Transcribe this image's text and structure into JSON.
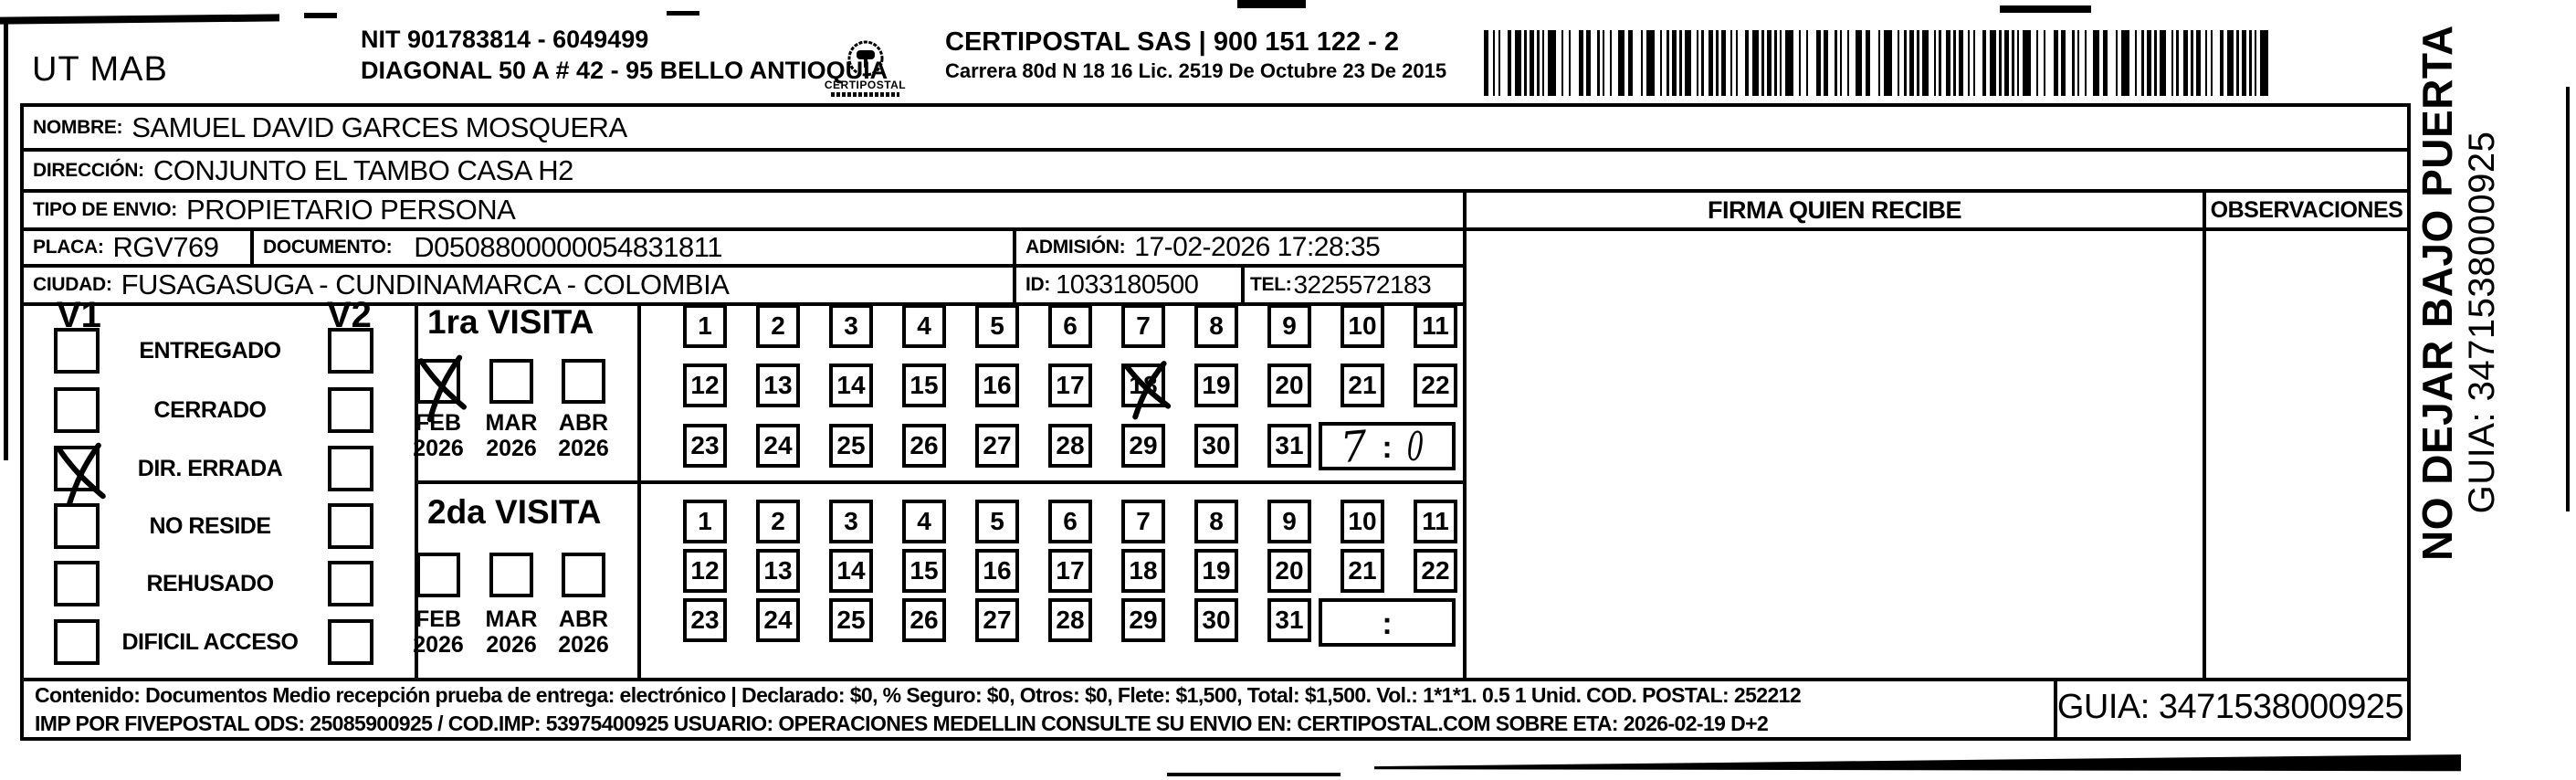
{
  "header": {
    "sender": "UT MAB",
    "nit_line1": "NIT 901783814 - 6049499",
    "nit_line2": "DIAGONAL 50 A # 42 - 95  BELLO  ANTIOQUIA",
    "logo_text": "CERTIPOSTAL",
    "company_line1": "CERTIPOSTAL SAS | 900 151 122 - 2",
    "company_line2": "Carrera 80d N 18 16  Lic. 2519 De Octubre 23 De 2015"
  },
  "recipient": {
    "nombre_label": "NOMBRE:",
    "nombre": "SAMUEL DAVID GARCES MOSQUERA",
    "direccion_label": "DIRECCIÓN:",
    "direccion": "CONJUNTO EL TAMBO CASA H2",
    "tipo_label": "TIPO DE ENVIO:",
    "tipo": "PROPIETARIO PERSONA",
    "placa_label": "PLACA:",
    "placa": "RGV769",
    "documento_label": "DOCUMENTO:",
    "documento": "D0508800000054831811",
    "admision_label": "ADMISIÓN:",
    "admision": "17-02-2026 17:28:35",
    "ciudad_label": "CIUDAD:",
    "ciudad": "FUSAGASUGA - CUNDINAMARCA - COLOMBIA",
    "id_label": "ID:",
    "id": "1033180500",
    "tel_label": "TEL:",
    "tel": "3225572183"
  },
  "columns": {
    "firma": "FIRMA QUIEN RECIBE",
    "observaciones": "OBSERVACIONES"
  },
  "status_panel": {
    "v1_label": "V1",
    "v2_label": "V2",
    "options": [
      {
        "label": "ENTREGADO",
        "v1_checked": false,
        "v2_checked": false
      },
      {
        "label": "CERRADO",
        "v1_checked": false,
        "v2_checked": false
      },
      {
        "label": "DIR. ERRADA",
        "v1_checked": true,
        "v2_checked": false
      },
      {
        "label": "NO RESIDE",
        "v1_checked": false,
        "v2_checked": false
      },
      {
        "label": "REHUSADO",
        "v1_checked": false,
        "v2_checked": false
      },
      {
        "label": "DIFICIL ACCESO",
        "v1_checked": false,
        "v2_checked": false
      }
    ]
  },
  "day_numbers": [
    1,
    2,
    3,
    4,
    5,
    6,
    7,
    8,
    9,
    10,
    11,
    12,
    13,
    14,
    15,
    16,
    17,
    18,
    19,
    20,
    21,
    22,
    23,
    24,
    25,
    26,
    27,
    28,
    29,
    30,
    31
  ],
  "visits": [
    {
      "title": "1ra VISITA",
      "months": [
        {
          "month": "FEB",
          "year": "2026",
          "checked": true
        },
        {
          "month": "MAR",
          "year": "2026",
          "checked": false
        },
        {
          "month": "ABR",
          "year": "2026",
          "checked": false
        }
      ],
      "crossed_day": 18,
      "time_separator": ":",
      "time_hour": "7",
      "time_minute": "0"
    },
    {
      "title": "2da VISITA",
      "months": [
        {
          "month": "FEB",
          "year": "2026",
          "checked": false
        },
        {
          "month": "MAR",
          "year": "2026",
          "checked": false
        },
        {
          "month": "ABR",
          "year": "2026",
          "checked": false
        }
      ],
      "crossed_day": null,
      "time_separator": ":",
      "time_hour": "",
      "time_minute": ""
    }
  ],
  "side_note": {
    "line1": "NO DEJAR BAJO PUERTA",
    "line2": "GUIA: 3471538000925"
  },
  "footer": {
    "line1": "Contenido: Documentos Medio recepción prueba de entrega: electrónico | Declarado: $0, % Seguro: $0, Otros: $0, Flete: $1,500, Total: $1,500. Vol.: 1*1*1. 0.5  1 Unid. COD. POSTAL: 252212",
    "line2": "IMP POR FIVEPOSTAL ODS: 25085900925 / COD.IMP: 53975400925 USUARIO: OPERACIONES MEDELLIN CONSULTE SU ENVIO EN: CERTIPOSTAL.COM SOBRE ETA: 2026-02-19 D+2",
    "guia": "GUIA: 3471538000925"
  },
  "colors": {
    "ink": "#000000",
    "paper": "#ffffff"
  }
}
